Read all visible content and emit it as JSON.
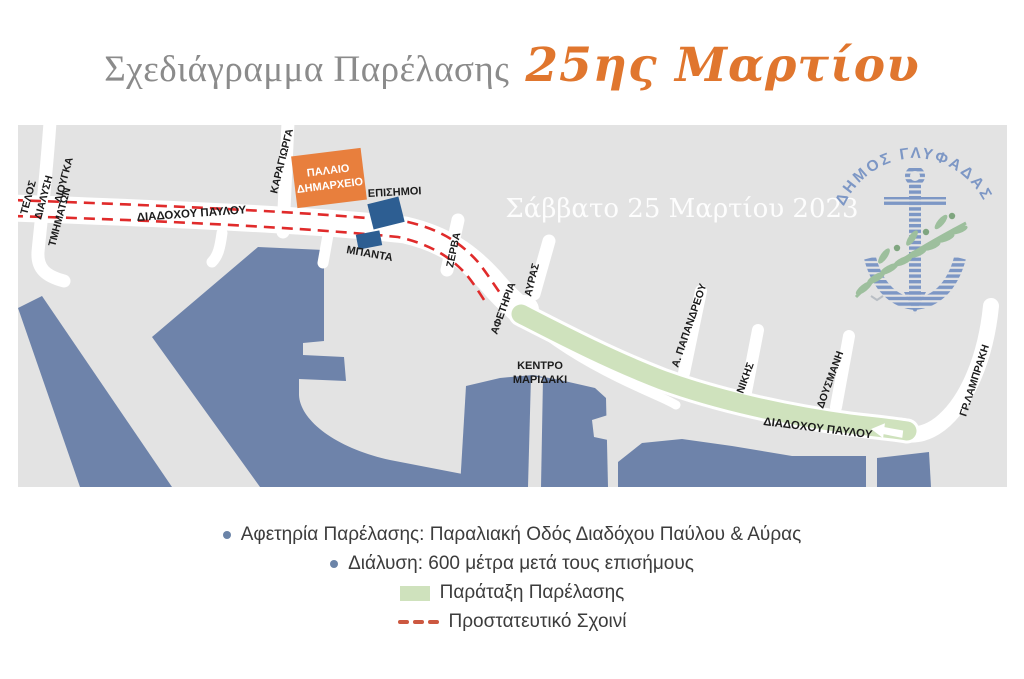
{
  "title": {
    "main": "Σχεδιάγραμμα Παρέλασης",
    "accent": "25ης Μαρτίου"
  },
  "map": {
    "watermark": "Σάββατο 25 Μαρτίου 2023",
    "logo_text": "ΔΗΜΟΣ ΓΛΥΦΑΔΑΣ",
    "buildings": {
      "old_town_hall_line1": "ΠΑΛΑΙΟ",
      "old_town_hall_line2": "ΔΗΜΑΡΧΕΙΟ"
    },
    "labels": {
      "telos": "ΤΕΛΟΣ",
      "dialysi": "ΔΙΑΛΥΣΗ",
      "tmimaton": "ΤΜΗΜΑΤΩΝ",
      "liougka": "ΛΙΟΥΓΚΑ",
      "diadochou_pavlou_upper": "ΔΙΑΔΟΧΟΥ ΠΑΥΛΟΥ",
      "karagiorga": "ΚΑΡΑΓΙΩΡΓΑ",
      "episimoi": "ΕΠΙΣΗΜΟΙ",
      "mpanta": "ΜΠΑΝΤΑ",
      "zerva": "ΖΕΡΒΑ",
      "afetiria": "ΑΦΕΤΗΡΙΑ",
      "avras": "ΑΥΡΑΣ",
      "kentro": "ΚΕΝΤΡΟ",
      "maridaki": "ΜΑΡΙΔΑΚΙ",
      "papandreou": "Α. ΠΑΠΑΝΔΡΕΟΥ",
      "nikis": "ΝΙΚΗΣ",
      "dousmani": "ΔΟΥΣΜΑΝΗ",
      "lampraki": "ΓΡ.ΛΑΜΠΡΑΚΗ",
      "diadochou_pavlou_coastal": "ΔΙΑΔΟΧΟΥ ΠΑΥΛΟΥ"
    }
  },
  "legend": {
    "items": [
      {
        "marker": "bullet",
        "text": "Αφετηρία Παρέλασης: Παραλιακή Οδός Διαδόχου Παύλου & Αύρας"
      },
      {
        "marker": "bullet",
        "text": "Διάλυση: 600 μέτρα μετά τους επισήμους"
      },
      {
        "marker": "green-box",
        "text": "Παράταξη Παρέλασης"
      },
      {
        "marker": "red-dashes",
        "text": "Προστατευτικό Σχοινί"
      }
    ]
  },
  "colors": {
    "accent_orange": "#e0762e",
    "map_background": "#e3e3e3",
    "water_blue": "#6e83aa",
    "parade_green": "#cfe2bd",
    "rope_red": "#e02b2b",
    "legend_dash_red": "#cc5840",
    "building_orange": "#e87f3d",
    "official_navy": "#2d5e92",
    "logo_blue": "#7d97c5",
    "olive_green": "#9dbf9d"
  }
}
